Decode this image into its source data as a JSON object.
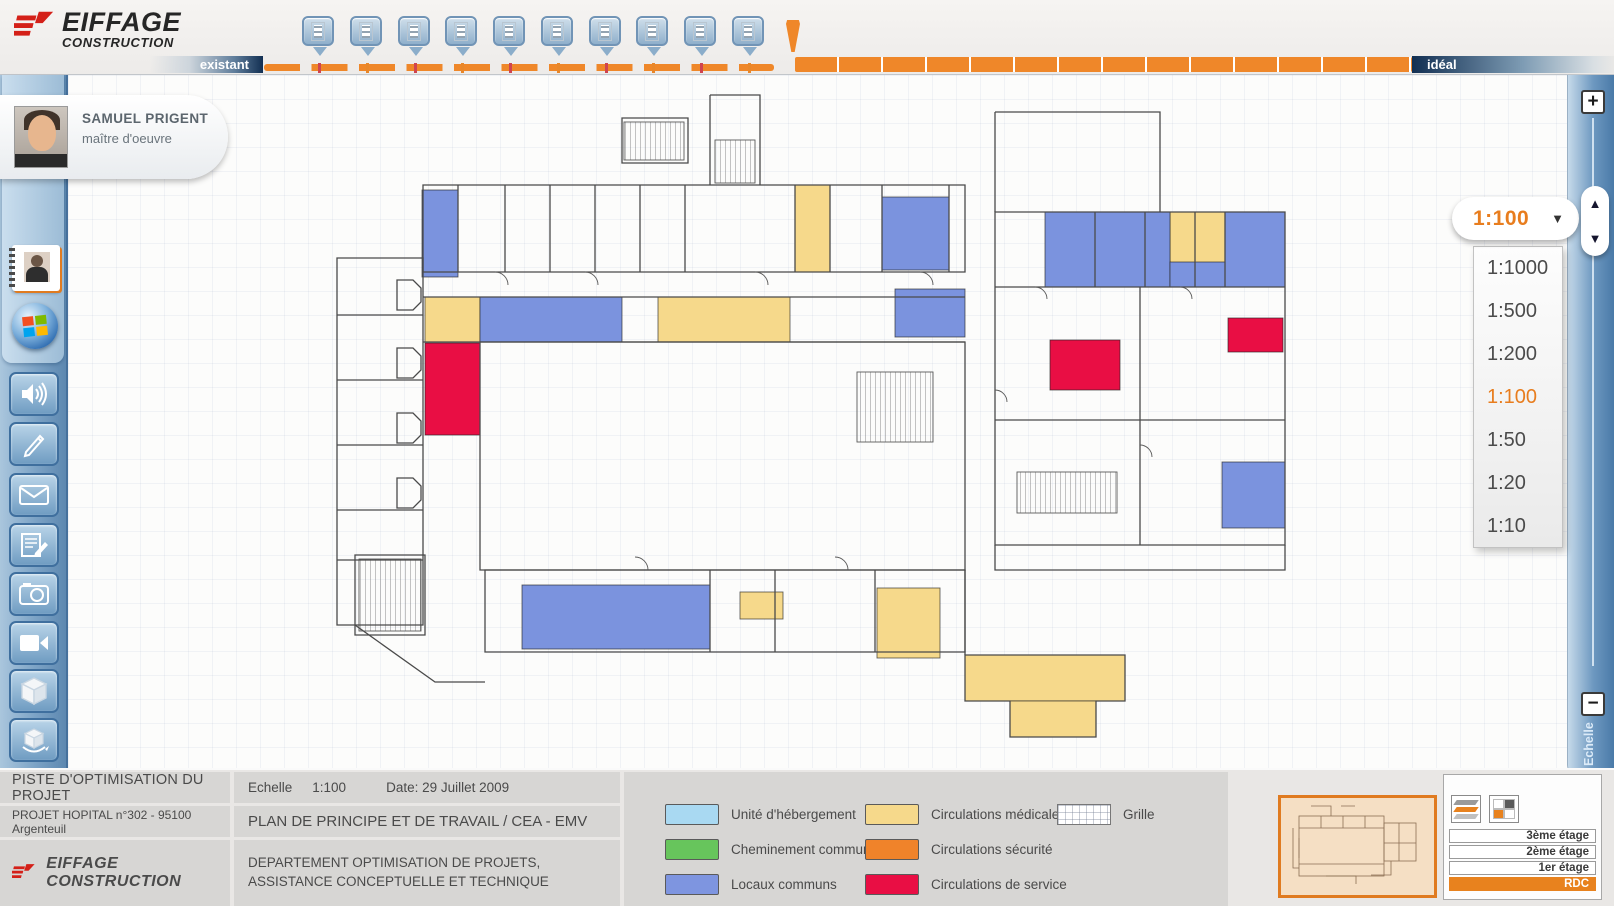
{
  "app": {
    "brand": "EIFFAGE",
    "brand_sub": "CONSTRUCTION"
  },
  "header": {
    "left_tab": "existant",
    "right_tab": "idéal",
    "timeline": {
      "marker_count": 10,
      "tick_colors": [
        "#cf4450",
        "#e8872a"
      ]
    }
  },
  "profile": {
    "name": "SAMUEL PRIGENT",
    "role": "maître d'oeuvre"
  },
  "sidebar": {
    "calendar_day": "29"
  },
  "zoom_panel": {
    "selected": "1:100",
    "options": [
      "1:1000",
      "1:500",
      "1:200",
      "1:100",
      "1:50",
      "1:20",
      "1:10"
    ],
    "dropdown_arrow": "▼",
    "up_arrow": "▲",
    "down_arrow": "▼",
    "plus": "+",
    "minus": "−",
    "rail_label": "Echelle",
    "accent_color": "#e87d1e"
  },
  "legend": {
    "col1": [
      {
        "label": "Unité d'hébergement",
        "color": "#a9d9f2"
      },
      {
        "label": "Cheminement commun",
        "color": "#67c55c"
      },
      {
        "label": "Locaux communs",
        "color": "#7e95e0"
      }
    ],
    "col2": [
      {
        "label": "Circulations médicale",
        "color": "#f6d98b"
      },
      {
        "label": "Circulations sécurité",
        "color": "#f0832a"
      },
      {
        "label": "Circulations de service",
        "color": "#e90e44"
      }
    ],
    "grille_label": "Grille"
  },
  "info_table": {
    "title": "PISTE D'OPTIMISATION DU PROJET",
    "echelle_label": "Echelle",
    "echelle_value": "1:100",
    "date": "Date: 29 Juillet 2009",
    "project": "PROJET HOPITAL n°302 - 95100 Argenteuil",
    "plan_title": "PLAN DE PRINCIPE ET DE TRAVAIL / CEA - EMV",
    "brand": "EIFFAGE  CONSTRUCTION",
    "department_line1": "DEPARTEMENT OPTIMISATION DE PROJETS,",
    "department_line2": "ASSISTANCE CONCEPTUELLE ET TECHNIQUE"
  },
  "floor_selector": {
    "floors": [
      "3ème étage",
      "2ème étage",
      "1er étage",
      "RDC"
    ],
    "active": "RDC",
    "active_color": "#e8821e"
  },
  "floor_plan": {
    "colors": {
      "blue": "#7b93de",
      "yellow": "#f6d98b",
      "red": "#e90e44"
    },
    "zones": [
      {
        "type": "blue",
        "x": 87,
        "y": 100,
        "w": 36,
        "h": 87
      },
      {
        "type": "yellow",
        "x": 460,
        "y": 95,
        "w": 35,
        "h": 87
      },
      {
        "type": "blue",
        "x": 547,
        "y": 107,
        "w": 67,
        "h": 73
      },
      {
        "type": "yellow",
        "x": 835,
        "y": 122,
        "w": 55,
        "h": 60
      },
      {
        "type": "blue",
        "x": 710,
        "y": 122,
        "w": 125,
        "h": 75
      },
      {
        "type": "blue",
        "x": 890,
        "y": 122,
        "w": 60,
        "h": 75
      },
      {
        "type": "blue",
        "x": 835,
        "y": 172,
        "w": 55,
        "h": 25
      },
      {
        "type": "yellow",
        "x": 90,
        "y": 207,
        "w": 55,
        "h": 45
      },
      {
        "type": "blue",
        "x": 145,
        "y": 207,
        "w": 142,
        "h": 45
      },
      {
        "type": "yellow",
        "x": 323,
        "y": 207,
        "w": 132,
        "h": 45
      },
      {
        "type": "blue",
        "x": 560,
        "y": 199,
        "w": 70,
        "h": 48
      },
      {
        "type": "red",
        "x": 90,
        "y": 253,
        "w": 55,
        "h": 92
      },
      {
        "type": "red",
        "x": 715,
        "y": 250,
        "w": 70,
        "h": 50
      },
      {
        "type": "red",
        "x": 893,
        "y": 228,
        "w": 55,
        "h": 34
      },
      {
        "type": "blue",
        "x": 887,
        "y": 372,
        "w": 63,
        "h": 66
      },
      {
        "type": "blue",
        "x": 187,
        "y": 495,
        "w": 188,
        "h": 64
      },
      {
        "type": "yellow",
        "x": 405,
        "y": 502,
        "w": 43,
        "h": 27
      },
      {
        "type": "yellow",
        "x": 542,
        "y": 498,
        "w": 63,
        "h": 70
      },
      {
        "type": "yellow",
        "x": 630,
        "y": 565,
        "w": 160,
        "h": 46
      },
      {
        "type": "yellow",
        "x": 675,
        "y": 611,
        "w": 86,
        "h": 36
      }
    ],
    "stairs": [
      {
        "x": 289,
        "y": 32,
        "w": 60,
        "h": 38
      },
      {
        "x": 380,
        "y": 50,
        "w": 40,
        "h": 43
      },
      {
        "x": 522,
        "y": 282,
        "w": 76,
        "h": 70
      },
      {
        "x": 682,
        "y": 382,
        "w": 100,
        "h": 41
      },
      {
        "x": 24,
        "y": 469,
        "w": 62,
        "h": 72
      }
    ],
    "walls": [
      "M2,168 H88 V535 H2 Z",
      "M2,225 H88",
      "M2,290 H88",
      "M2,355 H88",
      "M2,420 H88",
      "M2,470 H88",
      "M62,190 h16 l8,8 v14 l-8,8 h-16 Z",
      "M62,258 h16 l8,8 v14 l-8,8 h-16 Z",
      "M62,323 h16 l8,8 v14 l-8,8 h-16 Z",
      "M62,388 h16 l8,8 v14 l-8,8 h-16 Z",
      "M88,95 H630 V182 H88 Z",
      "M123,95 V182",
      "M170,95 V182",
      "M215,95 V182",
      "M260,95 V182",
      "M305,95 V182",
      "M350,95 V182",
      "M460,95 V182",
      "M495,95 V182",
      "M547,95 V182",
      "M614,95 V182",
      "M375,5 H425 V95",
      "M375,5 V95",
      "M287,28 H353 V73 H287 Z",
      "M660,22 H825 V122",
      "M660,22 V122",
      "M660,122 H950 V455 H660 Z",
      "M660,197 H950",
      "M660,330 H950",
      "M805,197 V455",
      "M760,122 V197",
      "M810,122 V197",
      "M860,122 V197",
      "M890,122 V197",
      "M88,207 H630",
      "M88,252 H630",
      "M145,252 H630 V480 H145 Z",
      "M150,480 H630 V562 H150 Z",
      "M375,480 V562",
      "M440,480 V562",
      "M540,480 V562",
      "M20,465 H90 V545 H20 Z",
      "M20,535 L100,592 H150",
      "M660,455 V480 H950 V455",
      "M630,480 V565",
      "M630,565 H790 V611 H761 V647 H675 V611 H630 Z"
    ],
    "doors": [
      "M160,182 a13,13 0 0 1 13,13",
      "M250,182 a13,13 0 0 1 13,13",
      "M420,182 a13,13 0 0 1 13,13",
      "M585,182 a13,13 0 0 1 13,13",
      "M700,197 a12,12 0 0 1 12,12",
      "M845,197 a12,12 0 0 1 12,12",
      "M300,467 a13,13 0 0 1 13,13",
      "M500,467 a13,13 0 0 1 13,13",
      "M660,300 a12,12 0 0 1 12,12",
      "M805,355 a12,12 0 0 1 12,12"
    ]
  }
}
